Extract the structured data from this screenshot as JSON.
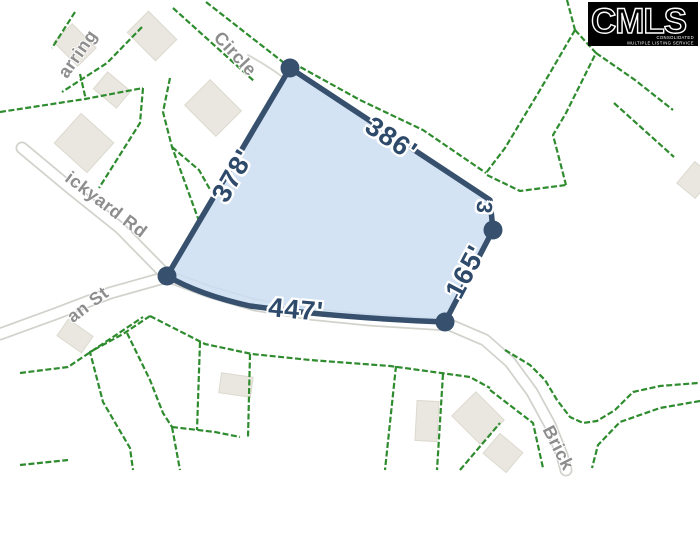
{
  "logo": {
    "text": "CMLS",
    "tagline_line1": "CONSOLIDATED",
    "tagline_line2": "MULTIPLE LISTING SERVICE"
  },
  "parcel": {
    "dimension_labels": [
      {
        "side": "top-right",
        "label": "386'"
      },
      {
        "side": "left",
        "label": "378'"
      },
      {
        "side": "bottom",
        "label": "447'"
      },
      {
        "side": "right",
        "label": "165'"
      },
      {
        "side": "right-short",
        "label": "3"
      }
    ],
    "colors": {
      "fill": "#cbdef2",
      "outline": "#36506e",
      "label": "#2e4a6b"
    }
  },
  "streets": [
    {
      "id": "harring",
      "label": "arring"
    },
    {
      "id": "circle",
      "label": "Circle"
    },
    {
      "id": "brickyard-rd",
      "label": "ickyard Rd"
    },
    {
      "id": "an-st",
      "label": "an St"
    },
    {
      "id": "brick",
      "label": "Brick"
    }
  ],
  "map_colors": {
    "lot_line_green": "#2e8b2e",
    "road_edge_gray": "#d2d2cd",
    "street_label_gray": "#8d8d8d",
    "building_fill": "#e9e7df",
    "logo_bg": "#000000",
    "logo_fg": "#ffffff"
  }
}
